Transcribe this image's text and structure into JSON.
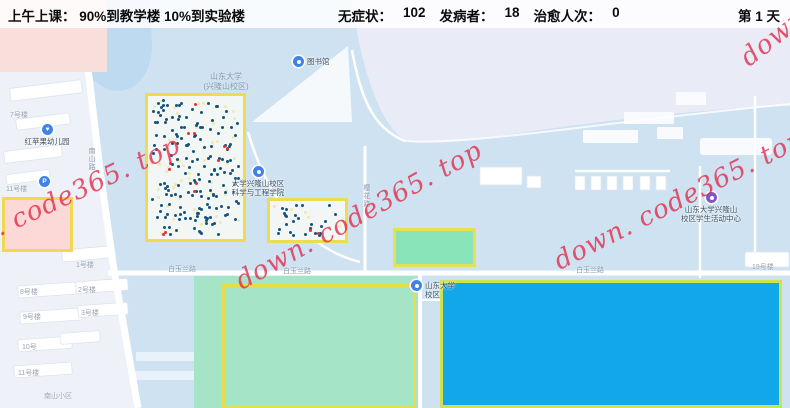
{
  "top_bar": {
    "schedule": "上午上课： 90%到教学楼 10%到实验楼",
    "stats": [
      {
        "label": "无症状：",
        "value": "102"
      },
      {
        "label": "发病者：",
        "value": "18"
      },
      {
        "label": "治愈人次：",
        "value": "0"
      }
    ],
    "day_counter": "第 1 天"
  },
  "map": {
    "campus_name1": "山东大学",
    "campus_name2": "(兴隆山校区)",
    "pois": [
      {
        "id": "library",
        "icon": "blue",
        "x": 298,
        "y": 61,
        "pos": "right",
        "lines": [
          "图书馆"
        ]
      },
      {
        "id": "kindergarten",
        "icon": "heart",
        "x": 47,
        "y": 129,
        "pos": "below",
        "lines": [
          "红苹果幼儿园"
        ]
      },
      {
        "id": "parking",
        "icon": "parking",
        "x": 44,
        "y": 181,
        "pos": "below",
        "lines": []
      },
      {
        "id": "materials-school",
        "icon": "blue",
        "x": 258,
        "y": 171,
        "pos": "below",
        "lines": [
          "大学兴隆山校区",
          "科学与工程学院"
        ]
      },
      {
        "id": "campus-gate",
        "icon": "blue",
        "x": 416,
        "y": 285,
        "pos": "right",
        "lines": [
          "山东大学",
          "校区"
        ]
      },
      {
        "id": "student-center",
        "icon": "purple",
        "x": 711,
        "y": 197,
        "pos": "below",
        "lines": [
          "山东大学兴隆山",
          "校区学生活动中心"
        ]
      }
    ],
    "road_labels": [
      {
        "text": "南山路",
        "x": 86,
        "y": 147,
        "vertical": true
      },
      {
        "text": "樱花路",
        "x": 361,
        "y": 184,
        "vertical": true
      },
      {
        "text": "白玉兰路",
        "x": 168,
        "y": 264,
        "vertical": false
      },
      {
        "text": "白玉兰路",
        "x": 283,
        "y": 266,
        "vertical": false
      },
      {
        "text": "白玉兰路",
        "x": 576,
        "y": 265,
        "vertical": false
      }
    ],
    "building_labels": [
      {
        "text": "7号楼",
        "x": 10,
        "y": 110
      },
      {
        "text": "11号楼",
        "x": 6,
        "y": 184
      },
      {
        "text": "1号楼",
        "x": 76,
        "y": 260
      },
      {
        "text": "8号楼",
        "x": 20,
        "y": 287
      },
      {
        "text": "2号楼",
        "x": 78,
        "y": 285
      },
      {
        "text": "9号楼",
        "x": 23,
        "y": 312
      },
      {
        "text": "3号楼",
        "x": 81,
        "y": 308
      },
      {
        "text": "10号",
        "x": 22,
        "y": 342
      },
      {
        "text": "11号楼",
        "x": 18,
        "y": 368
      },
      {
        "text": "南山小区",
        "x": 44,
        "y": 391
      },
      {
        "text": "19号楼",
        "x": 752,
        "y": 262
      }
    ],
    "zones": {
      "teaching": {
        "dots": {
          "navy": 168,
          "yellow": 50,
          "red": 12
        }
      },
      "lab": {
        "dots": {
          "navy": 25,
          "yellow": 6,
          "red": 2
        }
      }
    },
    "watermark": {
      "text": "down. code365. top"
    }
  },
  "colors": {
    "dot_navy": "#15527d",
    "dot_yellow": "#efe9b0",
    "dot_red": "#df3428",
    "zone_border": "#eddc4d",
    "teaching_fill": "#f2f7f6",
    "sports_fill": "#8ae4ba",
    "dorm_fill": "#a5e4c6",
    "hospital_fill": "#12a7e9",
    "pink_fill": "#fcd9d6",
    "watermark_red": "#e2304e"
  }
}
